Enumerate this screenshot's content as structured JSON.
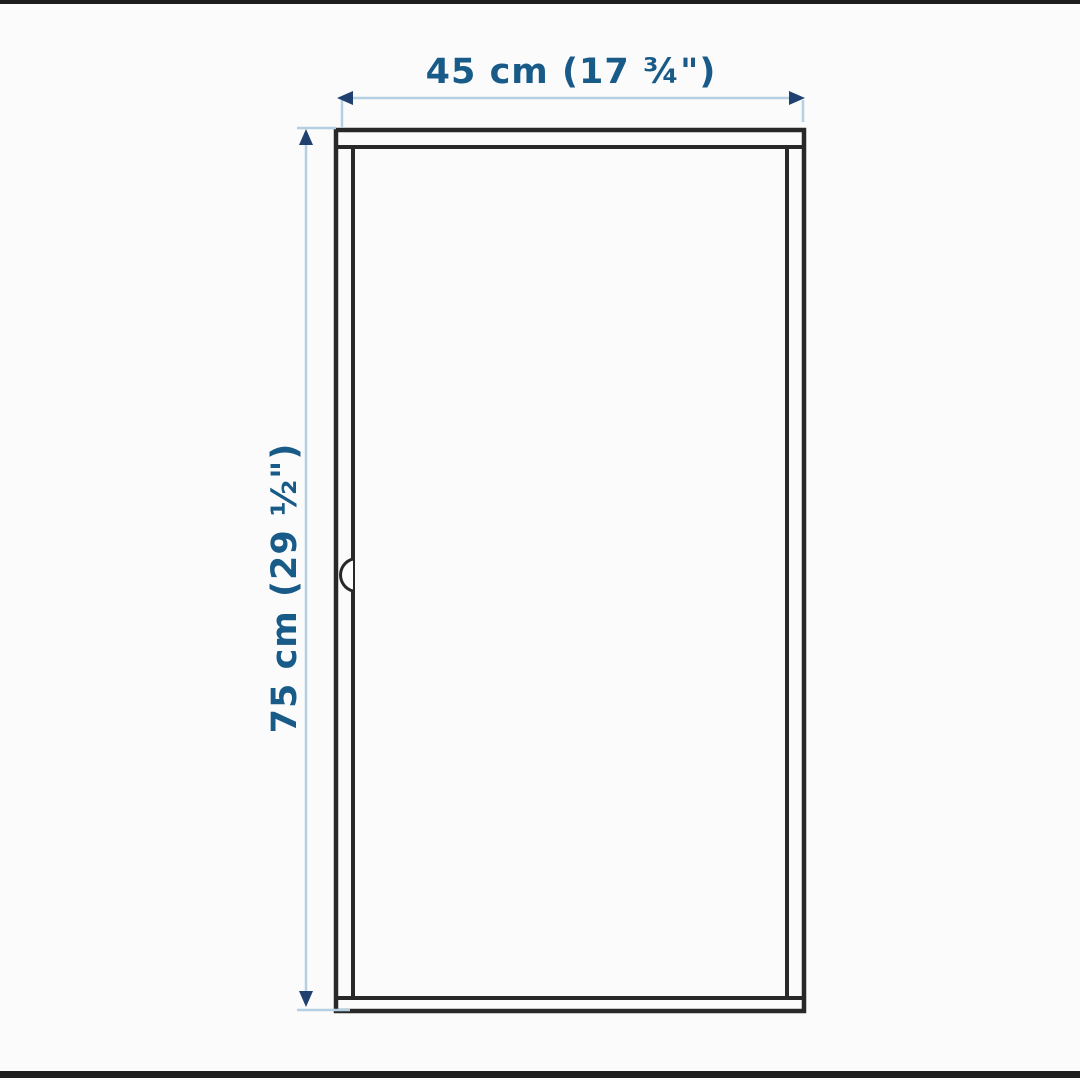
{
  "diagram": {
    "type": "product-dimension-drawing",
    "subject": "cabinet-with-door",
    "dimensions": {
      "width": {
        "label": "45 cm (17 ¾\")",
        "cm": 45,
        "inches": "17 3/4"
      },
      "height": {
        "label": "75 cm (29 ½\")",
        "cm": 75,
        "inches": "29 1/2"
      }
    }
  },
  "colors": {
    "label_text": "#185a88",
    "dimension_line": "#b4d0e2",
    "arrowhead": "#20416f",
    "cabinet_line": "#282828",
    "border_bar": "#1d1d1d",
    "background": "#fbfbfb"
  }
}
